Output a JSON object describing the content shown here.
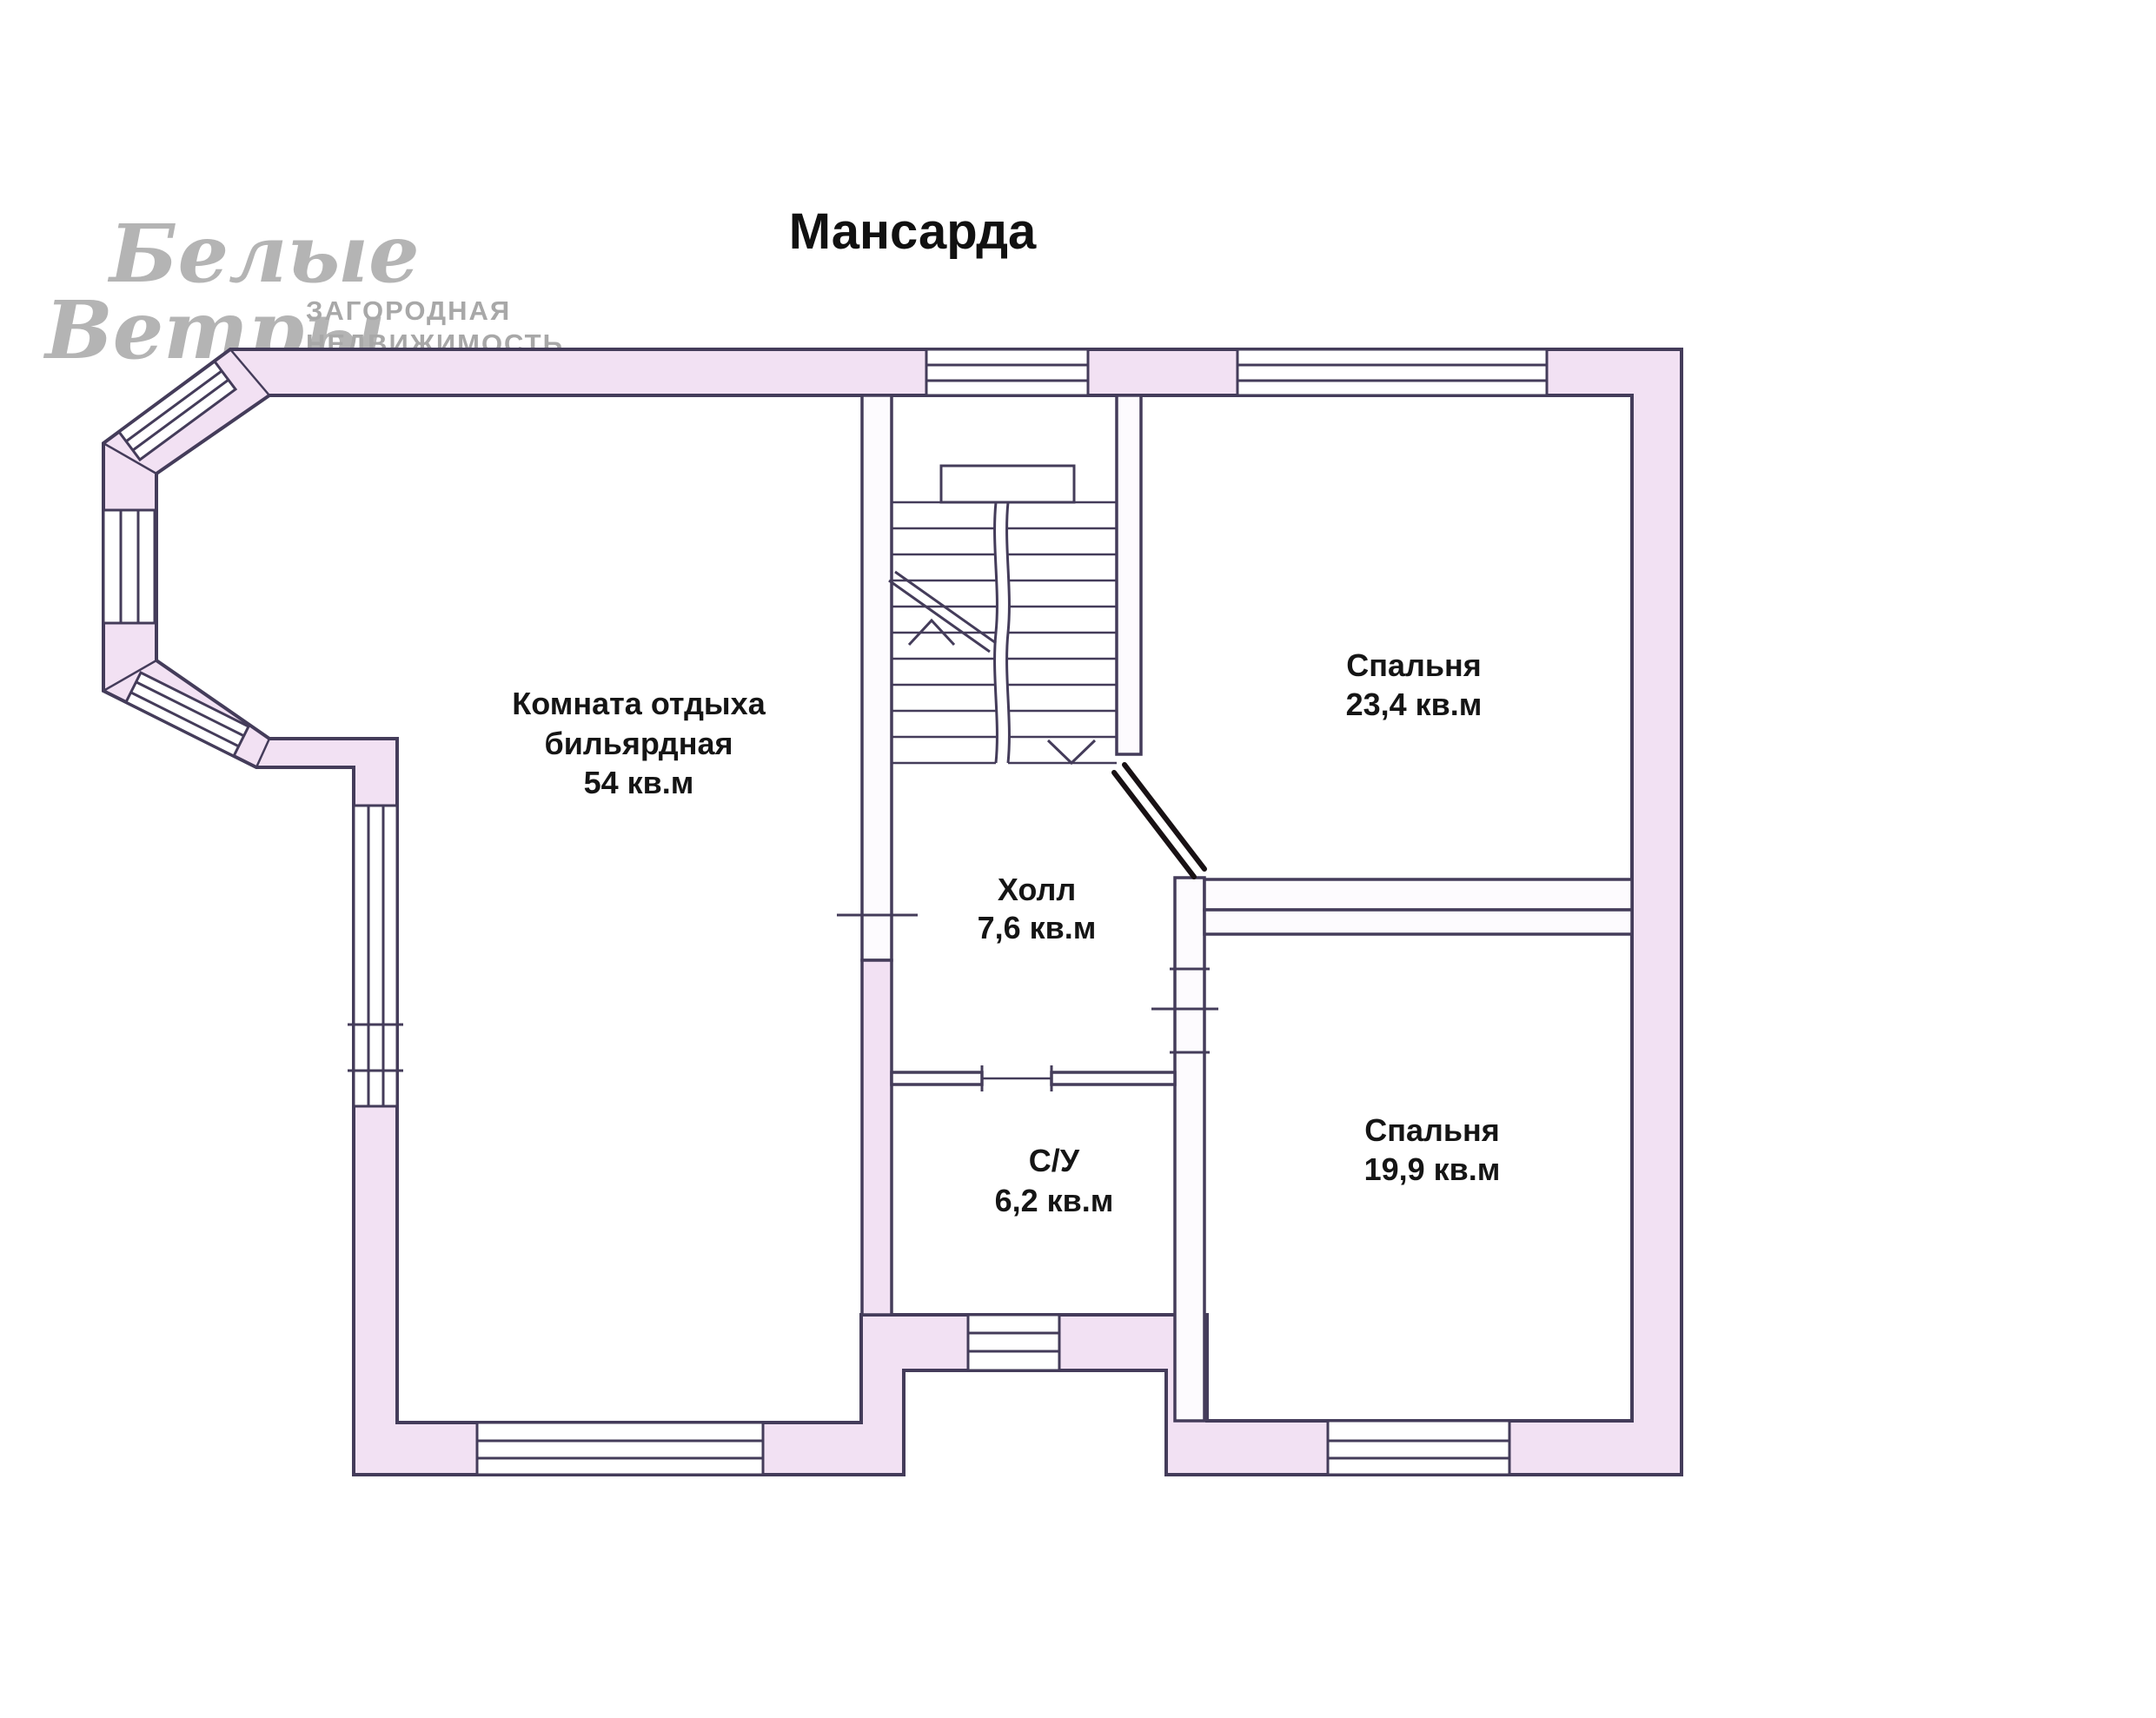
{
  "title": "Мансарда",
  "logo": {
    "script_line1": "Белые",
    "script_line2": "Ветры",
    "tagline_line1": "ЗАГОРОДНАЯ",
    "tagline_line2": "НЕДВИЖИМОСТЬ"
  },
  "rooms": {
    "billiard": {
      "name_line1": "Комната отдыха",
      "name_line2": "бильярдная",
      "area": "54 кв.м"
    },
    "bedroom_large": {
      "name": "Спальня",
      "area": "23,4 кв.м"
    },
    "hall": {
      "name": "Холл",
      "area": "7,6 кв.м"
    },
    "bathroom": {
      "name": "С/У",
      "area": "6,2 кв.м"
    },
    "bedroom_small": {
      "name": "Спальня",
      "area": "19,9 кв.м"
    }
  },
  "colors": {
    "wall_fill": "#f2e1f3",
    "line": "#443c5a",
    "label": "#151515",
    "logo_gray": "#b4b4b4",
    "tagline_gray": "#a8a8a8",
    "door_dark": "#181114"
  }
}
